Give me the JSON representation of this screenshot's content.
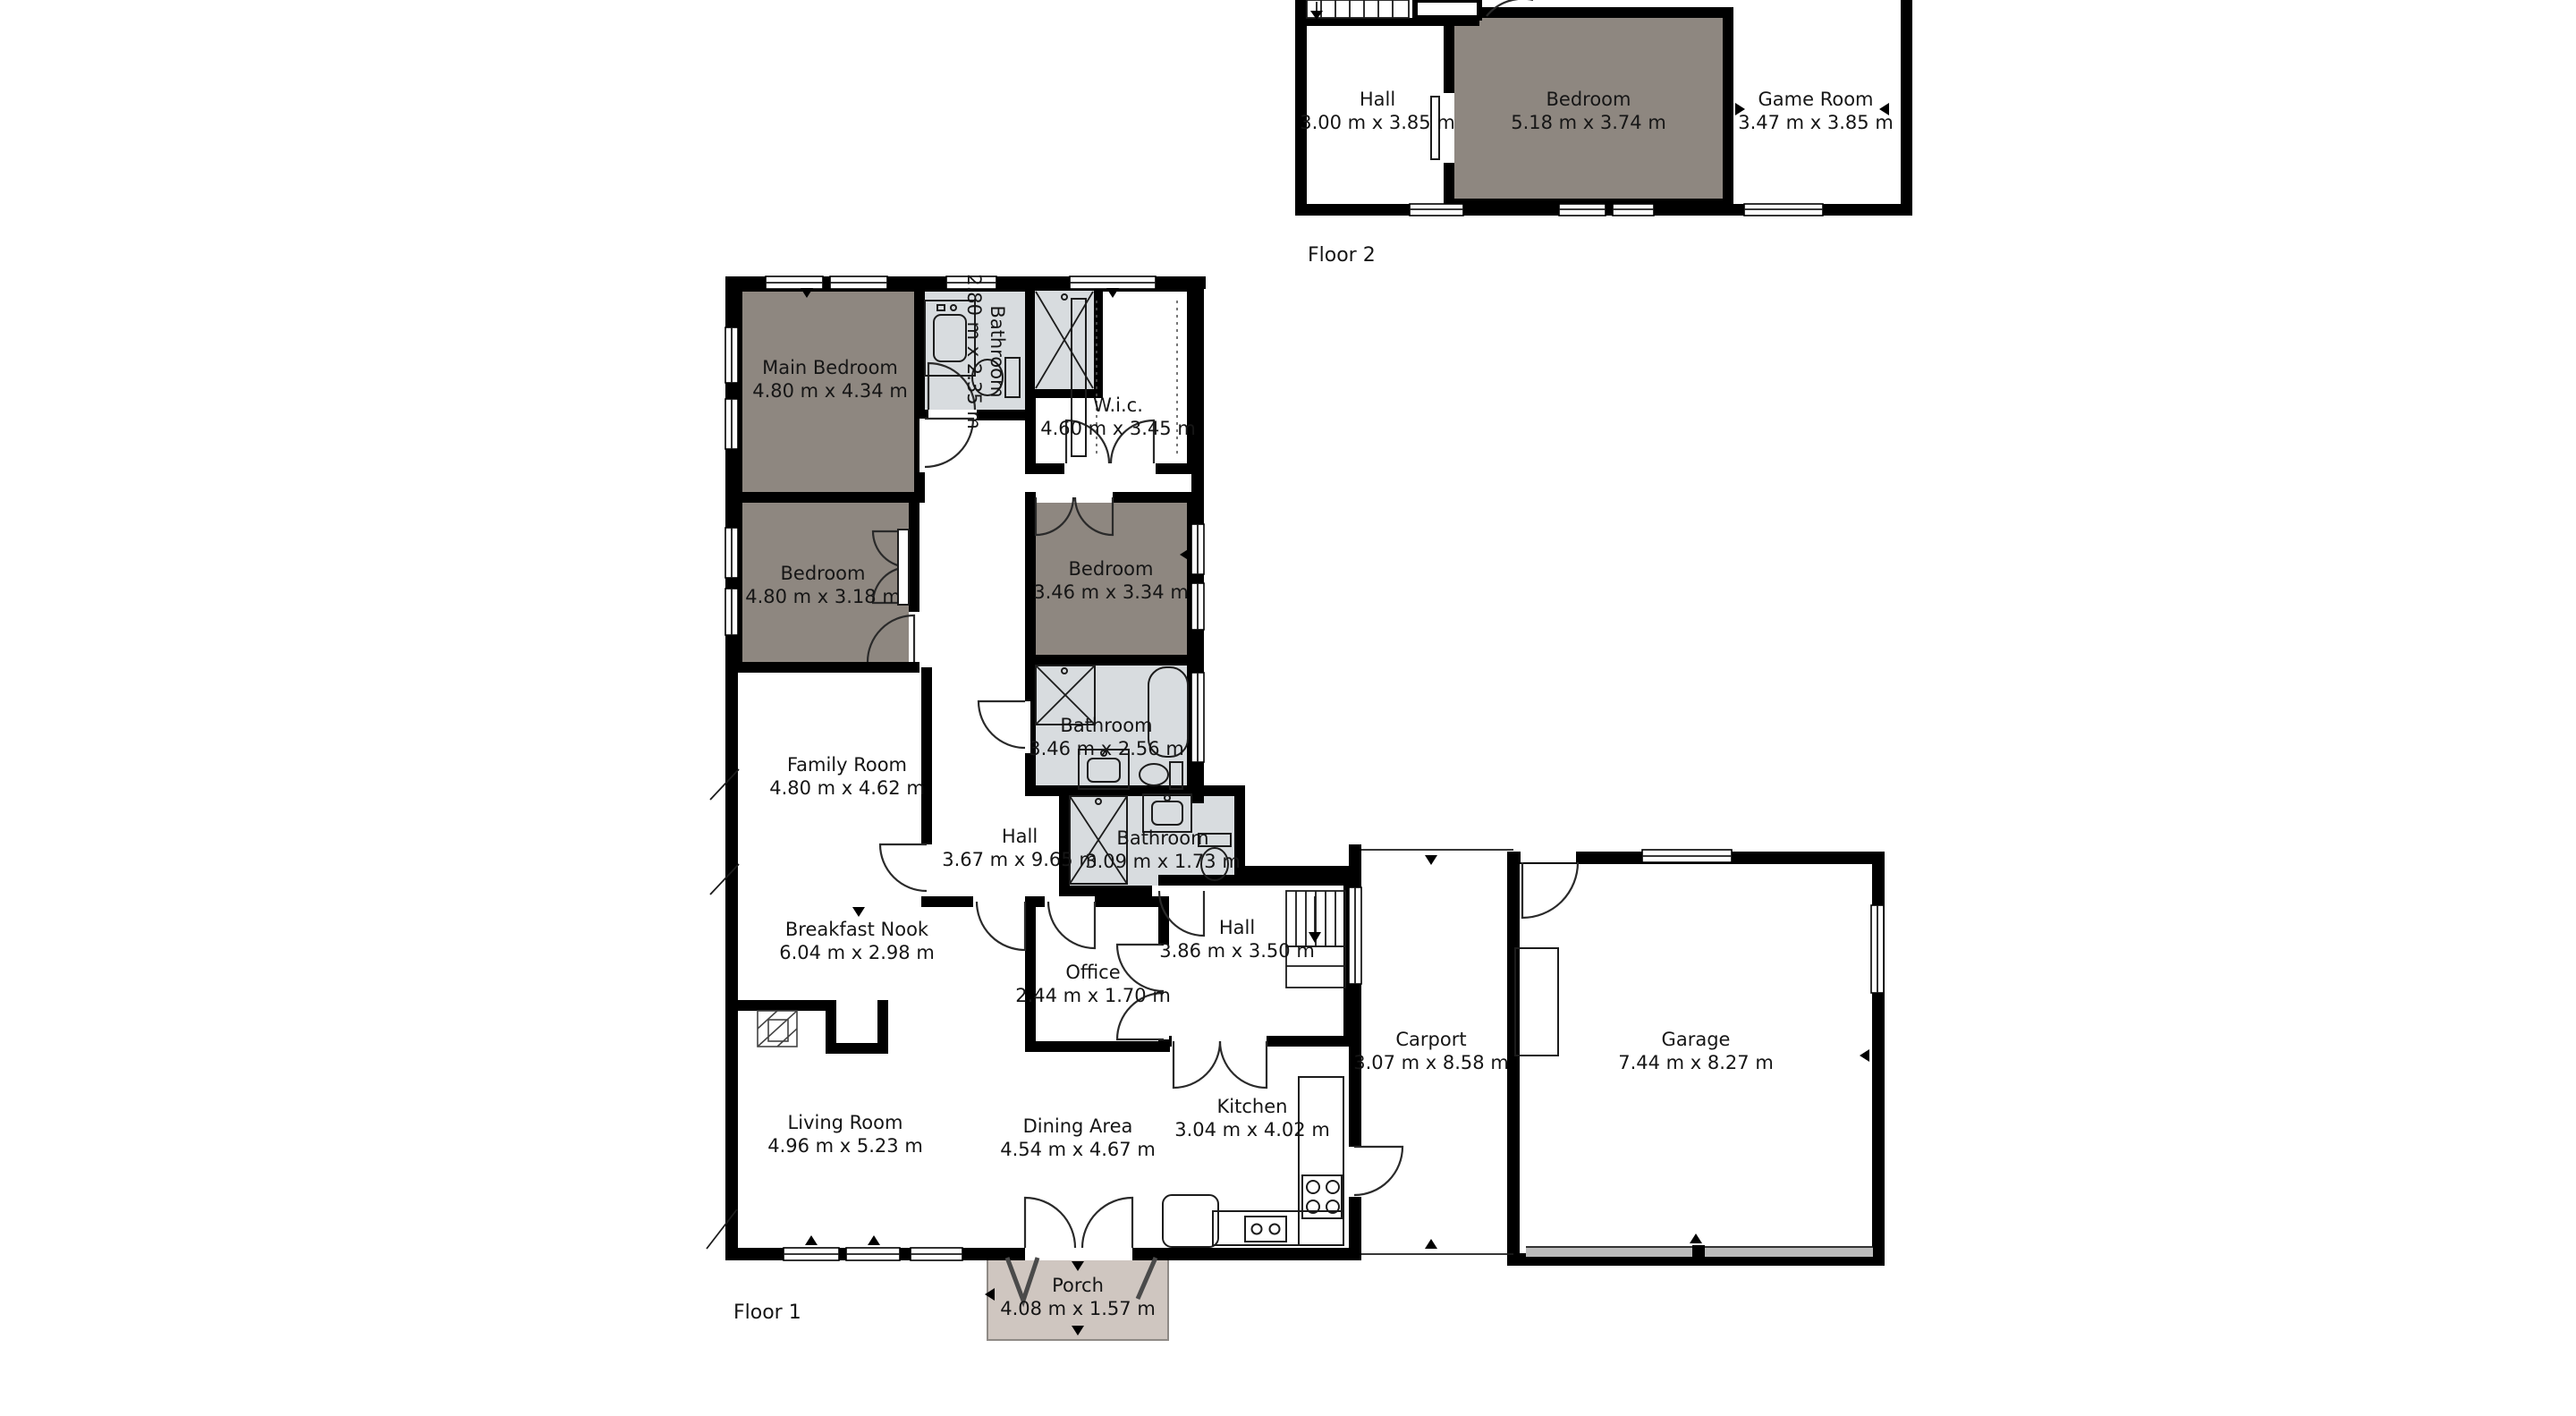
{
  "colors": {
    "wall": "#000000",
    "bedroom_fill": "#8e8780",
    "bathroom_fill": "#d8dcdf",
    "porch_fill": "#cfc6c0",
    "garage_door": "#bcbcbc",
    "background": "#ffffff"
  },
  "floor2": {
    "label": "Floor 2",
    "hall": {
      "name": "Hall",
      "dims": "3.00 m x 3.85 m"
    },
    "bedroom": {
      "name": "Bedroom",
      "dims": "5.18 m x 3.74 m"
    },
    "game_room": {
      "name": "Game Room",
      "dims": "3.47 m x 3.85 m"
    }
  },
  "floor1": {
    "label": "Floor 1",
    "main_bedroom": {
      "name": "Main Bedroom",
      "dims": "4.80 m x 4.34 m"
    },
    "bathroom_ensuite": {
      "name": "Bathroom",
      "dims": "2.80 m x 2.35 m"
    },
    "wic": {
      "name": "W.i.c.",
      "dims": "4.60 m x 3.45 m"
    },
    "bedroom_left": {
      "name": "Bedroom",
      "dims": "4.80 m x 3.18 m"
    },
    "bedroom_right": {
      "name": "Bedroom",
      "dims": "3.46 m x 3.34 m"
    },
    "bathroom_main": {
      "name": "Bathroom",
      "dims": "3.46 m x 2.56 m"
    },
    "hall_corridor": {
      "name": "Hall",
      "dims": "3.67 m x 9.65 m"
    },
    "bathroom_small": {
      "name": "Bathroom",
      "dims": "3.09 m x 1.73 m"
    },
    "family_room": {
      "name": "Family Room",
      "dims": "4.80 m x 4.62 m"
    },
    "breakfast_nook": {
      "name": "Breakfast Nook",
      "dims": "6.04 m x 2.98 m"
    },
    "office": {
      "name": "Office",
      "dims": "2.44 m x 1.70 m"
    },
    "hall_stairs": {
      "name": "Hall",
      "dims": "3.86 m x 3.50 m"
    },
    "living_room": {
      "name": "Living Room",
      "dims": "4.96 m x 5.23 m"
    },
    "dining_area": {
      "name": "Dining Area",
      "dims": "4.54 m x 4.67 m"
    },
    "kitchen": {
      "name": "Kitchen",
      "dims": "3.04 m x 4.02 m"
    },
    "carport": {
      "name": "Carport",
      "dims": "3.07 m x 8.58 m"
    },
    "garage": {
      "name": "Garage",
      "dims": "7.44 m x 8.27 m"
    },
    "porch": {
      "name": "Porch",
      "dims": "4.08 m x 1.57 m"
    }
  }
}
